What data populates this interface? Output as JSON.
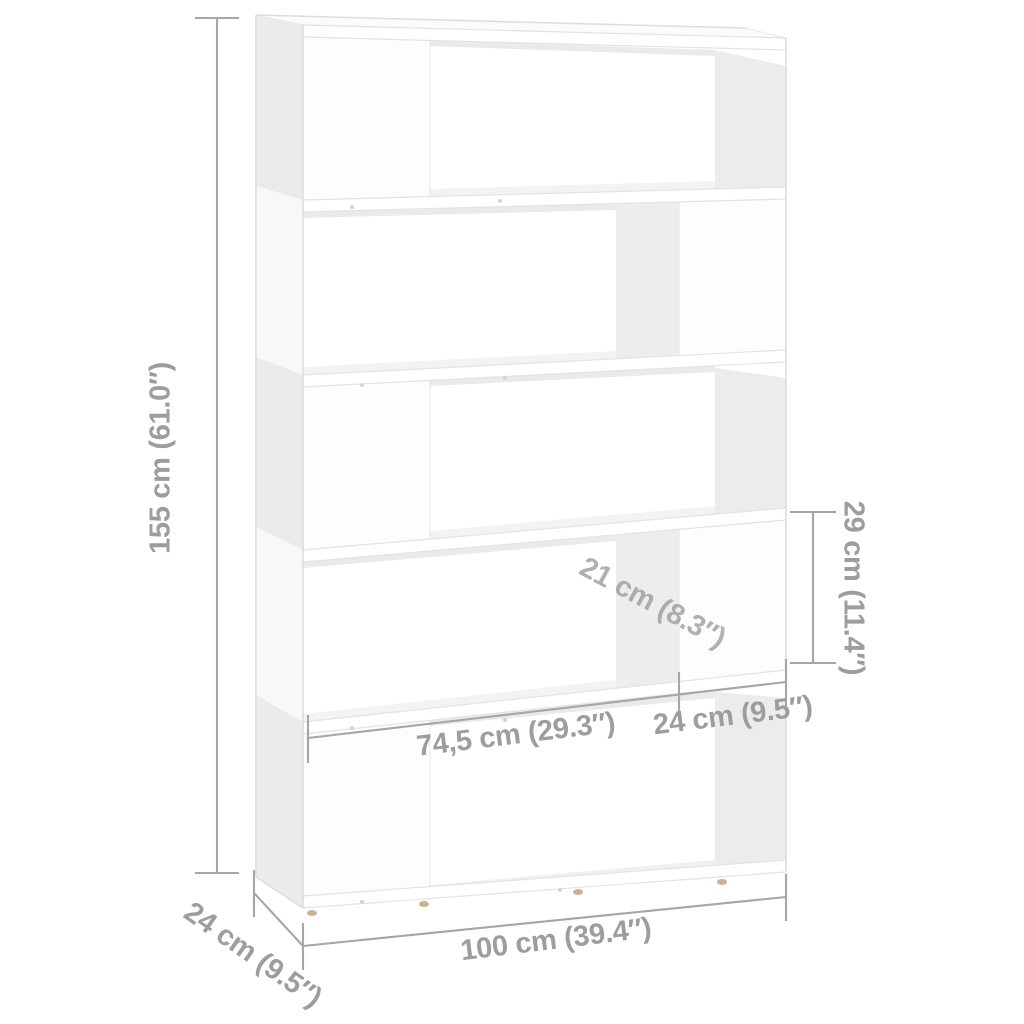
{
  "figure": {
    "description": "White five-tier book cabinet / room divider with staggered compartments, shown in perspective with gray dimension annotations",
    "dimensions": {
      "height": "155 cm (61.0″)",
      "depth": "24 cm (9.5″)",
      "width": "100 cm (39.4″)",
      "compartment_width": "74,5 cm (29.3″)",
      "divider_panel_width": "24 cm (9.5″)",
      "compartment_height": "29 cm (11.4″)",
      "compartment_depth": "21 cm (8.3″)"
    },
    "colors": {
      "background": "#ffffff",
      "furniture": "#ffffff",
      "interior_shading": "#ececec",
      "annotation_text": "#9d9d9d",
      "annotation_line": "#a6a6a6",
      "feet": "#c8b48e"
    }
  }
}
